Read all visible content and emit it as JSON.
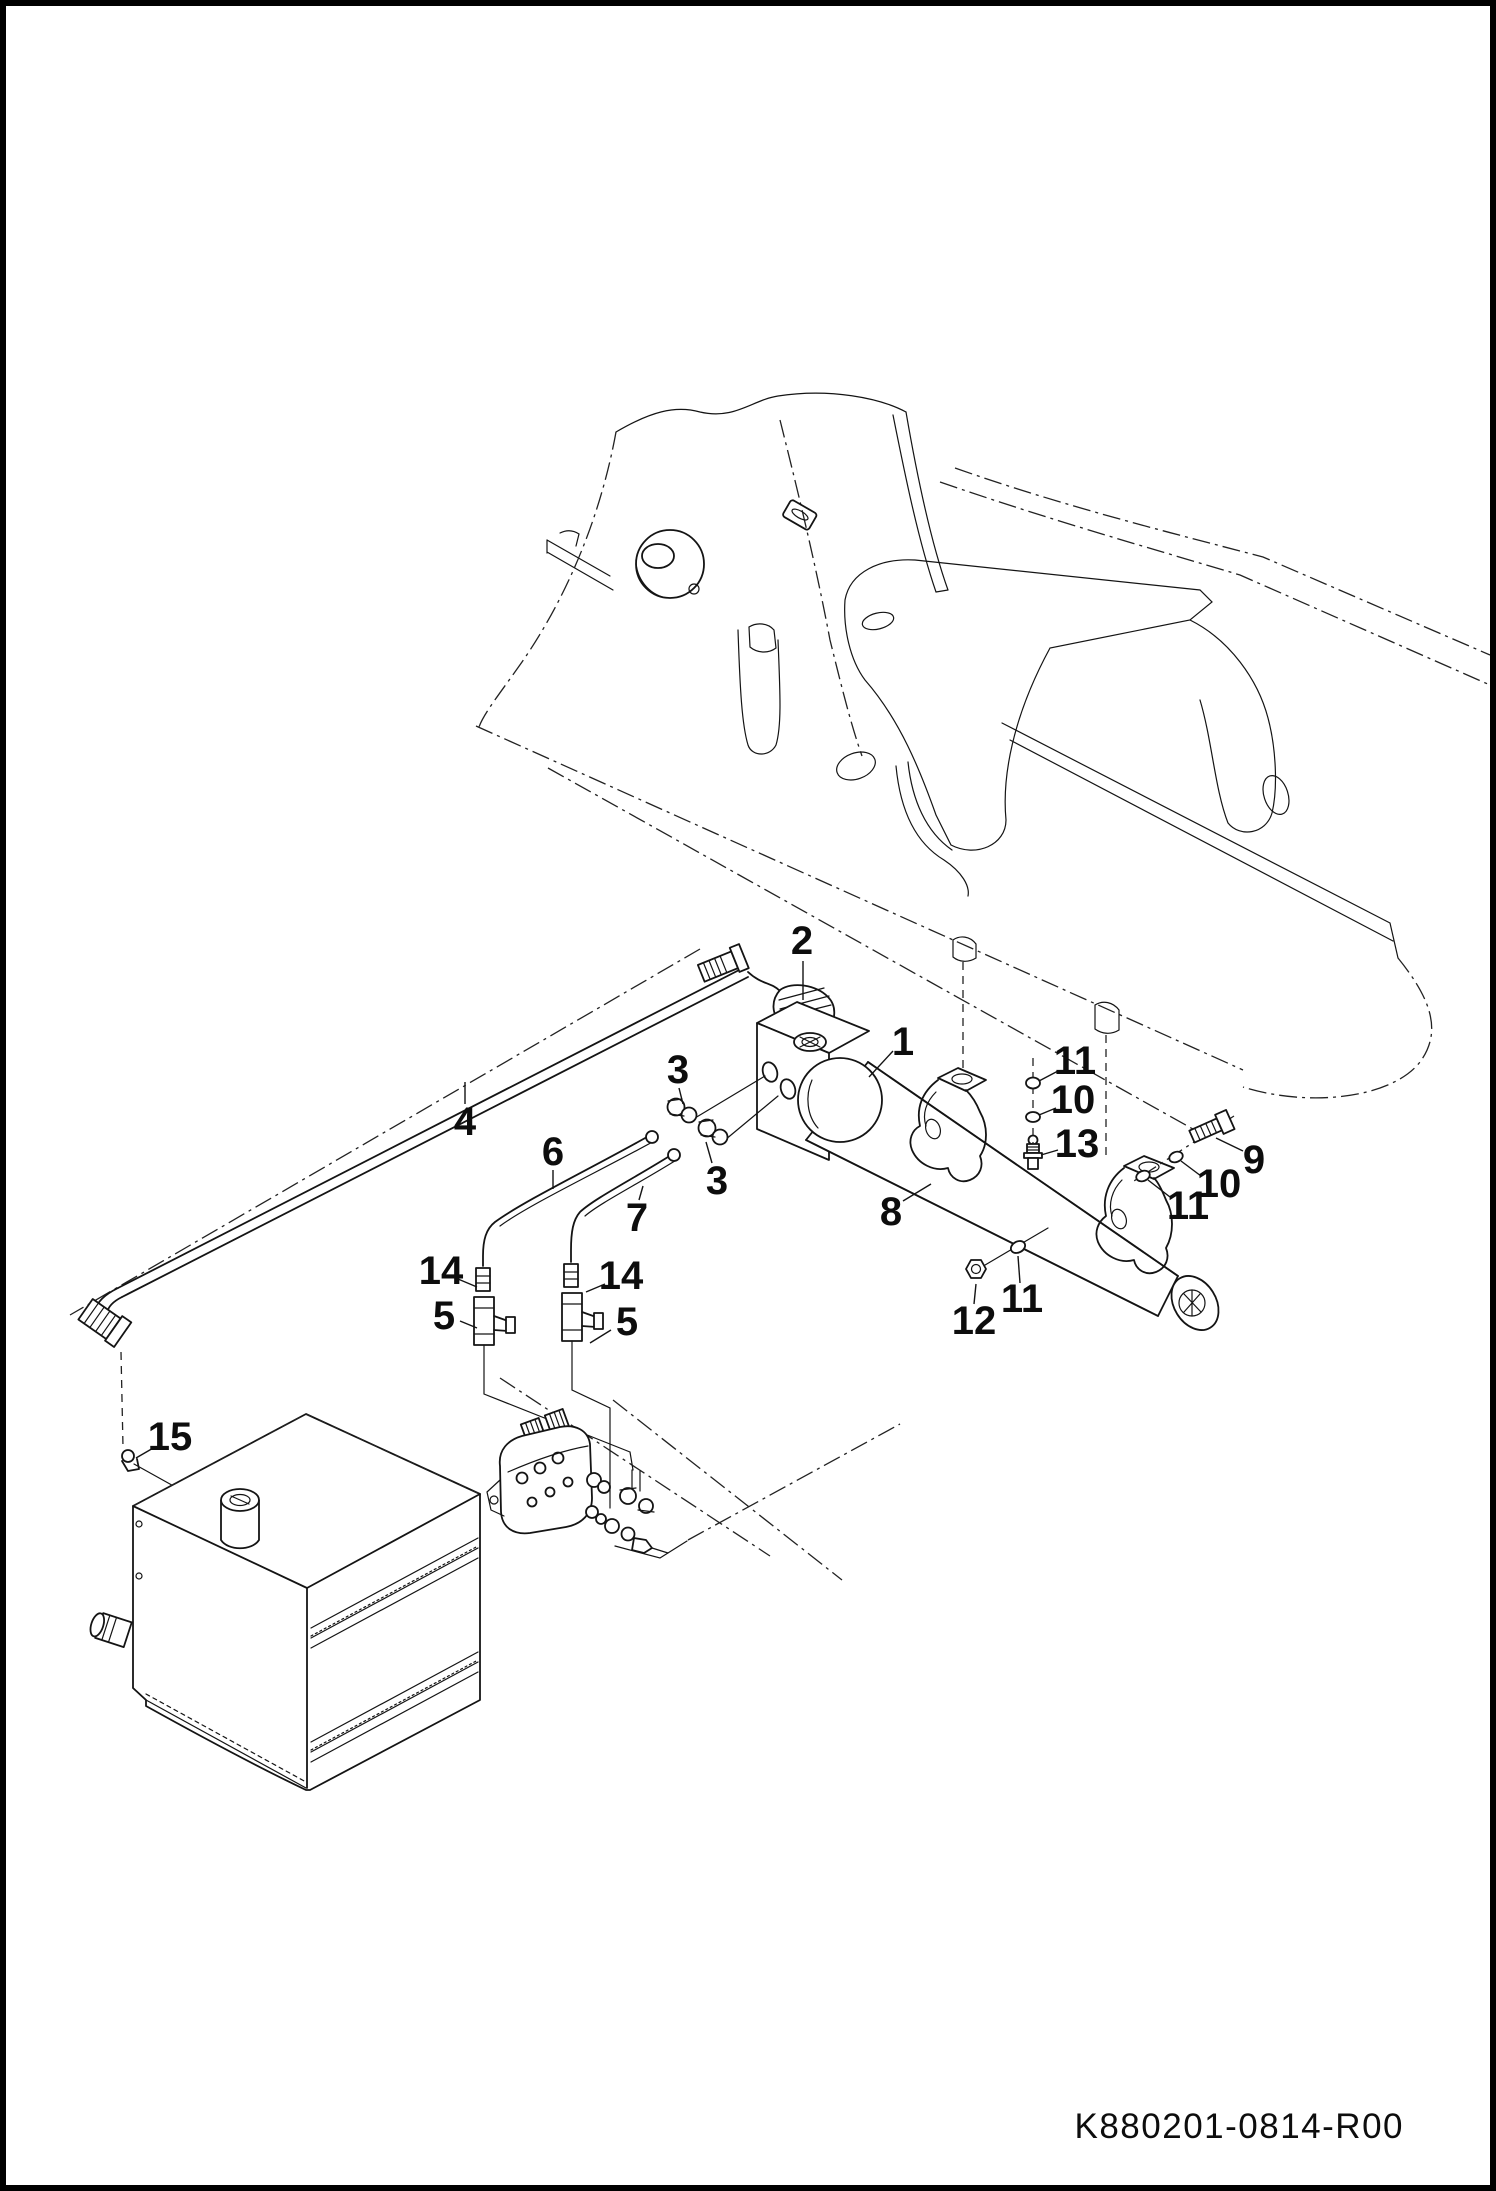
{
  "page": {
    "background_color": "#ffffff",
    "line_color": "#141414",
    "border_color": "#000000"
  },
  "drawing": {
    "number": "K880201-0814-R00",
    "type": "exploded-parts-diagram"
  },
  "part_numbers_shown": [
    "1",
    "2",
    "3",
    "4",
    "5",
    "6",
    "7",
    "8",
    "9",
    "10",
    "11",
    "12",
    "13",
    "14",
    "15"
  ],
  "callouts": [
    {
      "label": "1",
      "x": 903,
      "y": 1042,
      "leader": [
        [
          893,
          1051
        ],
        [
          869,
          1077
        ]
      ]
    },
    {
      "label": "2",
      "x": 802,
      "y": 941,
      "leader": [
        [
          803,
          961
        ],
        [
          803,
          1000
        ]
      ]
    },
    {
      "label": "3",
      "x": 678,
      "y": 1070,
      "leader": [
        [
          679,
          1088
        ],
        [
          683,
          1104
        ]
      ]
    },
    {
      "label": "3",
      "x": 717,
      "y": 1181,
      "leader": [
        [
          712,
          1163
        ],
        [
          706,
          1142
        ]
      ]
    },
    {
      "label": "4",
      "x": 465,
      "y": 1122,
      "leader": [
        [
          465,
          1104
        ],
        [
          465,
          1082
        ]
      ]
    },
    {
      "label": "5",
      "x": 444,
      "y": 1316,
      "leader": [
        [
          460,
          1321
        ],
        [
          477,
          1328
        ]
      ]
    },
    {
      "label": "5",
      "x": 627,
      "y": 1322,
      "leader": [
        [
          611,
          1330
        ],
        [
          590,
          1343
        ]
      ]
    },
    {
      "label": "6",
      "x": 553,
      "y": 1152,
      "leader": [
        [
          553,
          1170
        ],
        [
          553,
          1189
        ]
      ]
    },
    {
      "label": "7",
      "x": 637,
      "y": 1218,
      "leader": [
        [
          639,
          1200
        ],
        [
          643,
          1186
        ]
      ]
    },
    {
      "label": "8",
      "x": 891,
      "y": 1212,
      "leader": [
        [
          903,
          1201
        ],
        [
          931,
          1184
        ]
      ]
    },
    {
      "label": "9",
      "x": 1254,
      "y": 1160,
      "leader": [
        [
          1243,
          1151
        ],
        [
          1216,
          1138
        ]
      ]
    },
    {
      "label": "10",
      "x": 1219,
      "y": 1184,
      "leader": [
        [
          1201,
          1176
        ],
        [
          1181,
          1161
        ]
      ]
    },
    {
      "label": "11",
      "x": 1188,
      "y": 1206,
      "leader": [
        [
          1170,
          1197
        ],
        [
          1148,
          1180
        ]
      ]
    },
    {
      "label": "11",
      "x": 1075,
      "y": 1061,
      "leader": [
        [
          1058,
          1071
        ],
        [
          1039,
          1081
        ]
      ]
    },
    {
      "label": "10",
      "x": 1073,
      "y": 1100,
      "leader": [
        [
          1056,
          1108
        ],
        [
          1039,
          1115
        ]
      ]
    },
    {
      "label": "13",
      "x": 1077,
      "y": 1144,
      "leader": [
        [
          1058,
          1150
        ],
        [
          1041,
          1155
        ]
      ]
    },
    {
      "label": "11",
      "x": 1022,
      "y": 1299,
      "leader": [
        [
          1020,
          1283
        ],
        [
          1018,
          1256
        ]
      ]
    },
    {
      "label": "12",
      "x": 974,
      "y": 1321,
      "leader": [
        [
          974,
          1304
        ],
        [
          976,
          1284
        ]
      ]
    },
    {
      "label": "14",
      "x": 441,
      "y": 1271,
      "leader": [
        [
          458,
          1279
        ],
        [
          477,
          1287
        ]
      ]
    },
    {
      "label": "14",
      "x": 621,
      "y": 1276,
      "leader": [
        [
          605,
          1284
        ],
        [
          586,
          1292
        ]
      ]
    },
    {
      "label": "15",
      "x": 170,
      "y": 1437,
      "leader": [
        [
          155,
          1447
        ],
        [
          136,
          1458
        ]
      ]
    }
  ],
  "components": {
    "cylinder": "hydraulic tilt cylinder (1)",
    "elbow_fitting": "elbow fitting (2)",
    "connectors": "straight connectors (3)",
    "hoses": "hydraulic hose (4)",
    "tee_fittings": "tee fittings (5)",
    "tubes": "steel tube lines (6, 7)",
    "clamps": "cylinder rod clamps (8)",
    "hardware": "screw (9), washers (10, 11), nut (12), grease fitting (13), tube nuts (14), tank fitting (15)",
    "reference": "dozer blade frame, hydraulic tank and control valve shown in phantom lines"
  }
}
